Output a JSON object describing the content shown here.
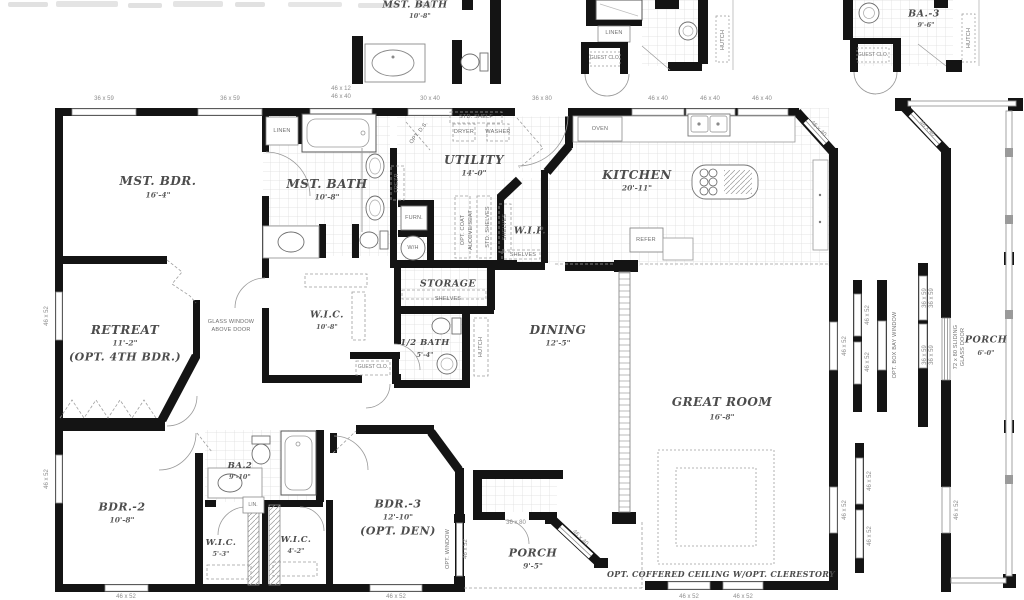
{
  "top": {
    "mst_bath_name": "MST. BATH",
    "mst_bath_dim": "10'-8\"",
    "linen": "LINEN",
    "guest_clo": "GUEST CLO.",
    "hutch": "HUTCH",
    "ba3_name": "BA.-3",
    "ba3_dim": "9'-6\"",
    "guest_clo2": "GUEST CLO.",
    "hutch2": "HUTCH"
  },
  "rooms": {
    "mst_bdr": {
      "name": "MST. BDR.",
      "dim": "16'-4\""
    },
    "mst_bath": {
      "name": "MST. BATH",
      "dim": "10'-8\""
    },
    "utility": {
      "name": "UTILITY",
      "dim": "14'-0\""
    },
    "kitchen": {
      "name": "KITCHEN",
      "dim": "20'-11\""
    },
    "wip": {
      "name": "W.I.P."
    },
    "retreat": {
      "name": "RETREAT",
      "dim": "11'-2\"",
      "note": "(OPT. 4TH BDR.)"
    },
    "wic_m": {
      "name": "W.I.C.",
      "dim": "10'-8\""
    },
    "storage": {
      "name": "STORAGE"
    },
    "half_bath": {
      "name": "1/2 BATH",
      "dim": "5'-4\""
    },
    "dining": {
      "name": "DINING",
      "dim": "12'-5\""
    },
    "great": {
      "name": "GREAT ROOM",
      "dim": "16'-8\""
    },
    "bdr2": {
      "name": "BDR.-2",
      "dim": "10'-8\""
    },
    "ba2": {
      "name": "BA.2",
      "dim": "9'-10\""
    },
    "wic2": {
      "name": "W.I.C.",
      "dim": "5'-3\""
    },
    "wic3": {
      "name": "W.I.C.",
      "dim": "4'-2\""
    },
    "bdr3": {
      "name": "BDR.-3",
      "dim": "12'-10\"",
      "note": "(OPT. DEN)"
    },
    "porch_rear": {
      "name": "PORCH",
      "dim": "9'-5\""
    },
    "porch_side": {
      "name": "PORCH",
      "dim": "6'-0\""
    }
  },
  "features": {
    "linen": "LINEN",
    "std_shelf": "STD. SHELF",
    "dryer": "DRYER",
    "washer": "WASHER",
    "opt_ds": "OPT. D.S.",
    "frezr": "FREZR",
    "furn": "FURN.",
    "wh": "W/H",
    "opt_coat": "OPT. COAT",
    "alcove": "ALCOVE/SEAT",
    "std_shelves": "STD. SHELVES",
    "shelves": "SHELVES",
    "oven": "OVEN",
    "refer": "REFER",
    "glass_win1": "GLASS WINDOW",
    "glass_win2": "ABOVE DOOR",
    "guest_clo": "GUEST CLO.",
    "hutch": "HUTCH",
    "lin": "LIN.",
    "opt_window": "OPT. WINDOW",
    "opt_bay": "OPT. BOX BAY WINDOW",
    "slider1": "72 x 80 SLIDING",
    "slider2": "GLASS DOOR",
    "coffered": "OPT. COFFERED CEILING W/OPT. CLERESTORY"
  },
  "dims": {
    "w36x59": "36 x 59",
    "w46x12": "46 x 12",
    "w46x40": "46 x 40",
    "w30x40": "30 x 40",
    "w36x80": "36 x 80",
    "w46x52": "46 x 52"
  }
}
